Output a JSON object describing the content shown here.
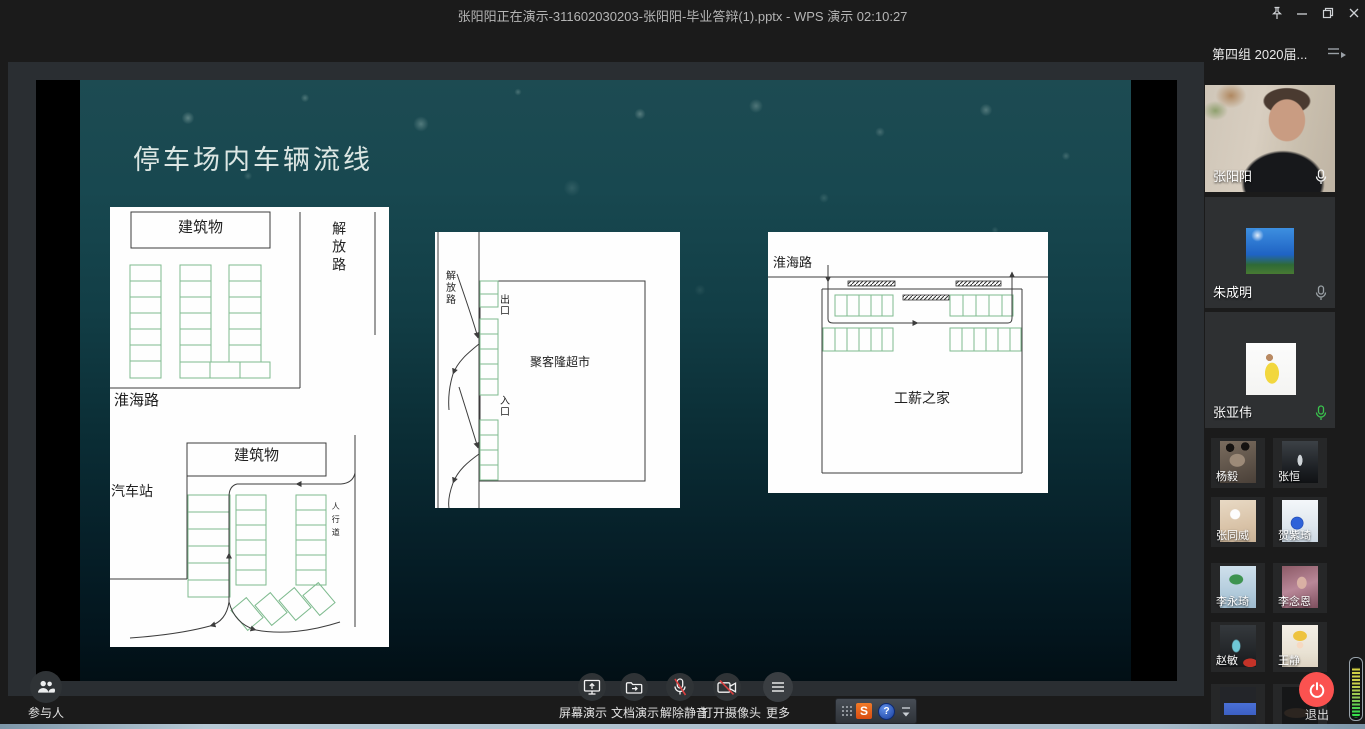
{
  "titlebar": {
    "title": "张阳阳正在演示-311602030203-张阳阳-毕业答辩(1).pptx - WPS 演示 02:10:27"
  },
  "sidebar": {
    "header_title": "第四组 2020届...",
    "large_tiles": [
      {
        "name": "张阳阳",
        "mic": "muted-white"
      },
      {
        "name": "朱成明",
        "mic": "muted-grey"
      },
      {
        "name": "张亚伟",
        "mic": "active-green"
      }
    ],
    "small_tiles": [
      {
        "name": "杨毅"
      },
      {
        "name": "张恒"
      },
      {
        "name": "张同威"
      },
      {
        "name": "贺紫琦"
      },
      {
        "name": "李永琦"
      },
      {
        "name": "李念恩"
      },
      {
        "name": "赵敏"
      },
      {
        "name": "王静"
      }
    ],
    "exit_label": "退出"
  },
  "bottombar": {
    "participants_label": "参与人",
    "buttons": [
      {
        "label": "屏幕演示"
      },
      {
        "label": "文档演示"
      },
      {
        "label": "解除静音"
      },
      {
        "label": "打开摄像头"
      },
      {
        "label": "更多"
      }
    ]
  },
  "float_widget": {
    "sign": "S",
    "help": "?"
  },
  "slide": {
    "title": "停车场内车辆流线",
    "diagram1": {
      "building": "建筑物",
      "jiefang_road": "解放路",
      "huaihai_road": "淮海路",
      "building2": "建筑物",
      "bus_station": "汽车站",
      "sidewalk": "人行道"
    },
    "diagram2": {
      "jiefang_road": "解放路",
      "exit": "出口",
      "entrance": "入口",
      "supermarket": "聚客隆超市"
    },
    "diagram3": {
      "huaihai_road": "淮海路",
      "building": "工薪之家"
    }
  },
  "colors": {
    "exit_red": "#fb5250",
    "mic_active_green": "#3ac24d",
    "stall_green": "#7fbb8f",
    "slash_red": "#d94040"
  }
}
